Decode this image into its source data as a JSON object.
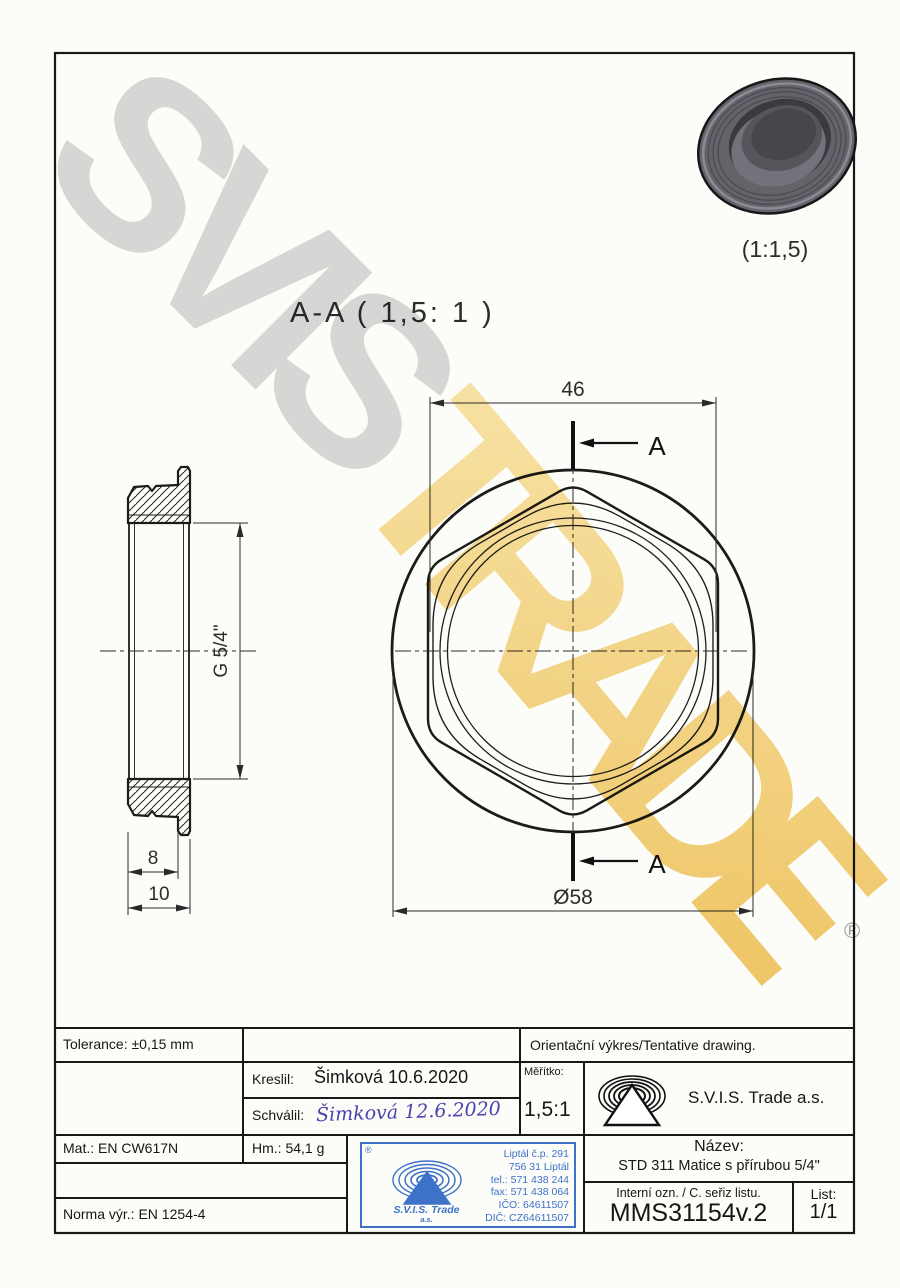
{
  "watermark": {
    "line1": "SVIS",
    "line2": "TRADE",
    "registered": "®"
  },
  "views": {
    "section_title": "A-A ( 1,5: 1 )",
    "iso_scale": "(1:1,5)",
    "cut_label": "A",
    "dims": {
      "across_flats": "46",
      "outer_diameter": "Ø58",
      "thread": "G 5/4\"",
      "body_thickness": "8",
      "total_thickness": "10"
    }
  },
  "titleblock": {
    "tolerance": "Tolerance: ±0,15 mm",
    "orientation_note": "Orientační výkres/Tentative drawing.",
    "kreslil_label": "Kreslil:",
    "kreslil_value": "Šimková 10.6.2020",
    "schvalil_label": "Schválil:",
    "schvalil_value": "Šimková 12.6.2020",
    "meritko_label": "Měřítko:",
    "meritko_value": "1,5:1",
    "company": "S.V.I.S. Trade a.s.",
    "mat": "Mat.: EN CW617N",
    "hm": "Hm.: 54,1 g",
    "norma": "Norma výr.: EN 1254-4",
    "nazev_label": "Název:",
    "nazev_value": "STD 311 Matice s přírubou 5/4\"",
    "interni_label": "Interní ozn. / C. seřiz listu.",
    "interni_value": "MMS31154v.2",
    "list_label": "List:",
    "list_value": "1/1"
  },
  "stamp": {
    "registered": "®",
    "company": "S.V.I.S. Trade",
    "suffix": "a.s.",
    "lines": [
      "Liptál č.p. 291",
      "756 31 Liptál",
      "tel.: 571 438 244",
      "fax: 571 438 064",
      "IČO: 64611507",
      "DIČ: CZ64611507"
    ]
  }
}
